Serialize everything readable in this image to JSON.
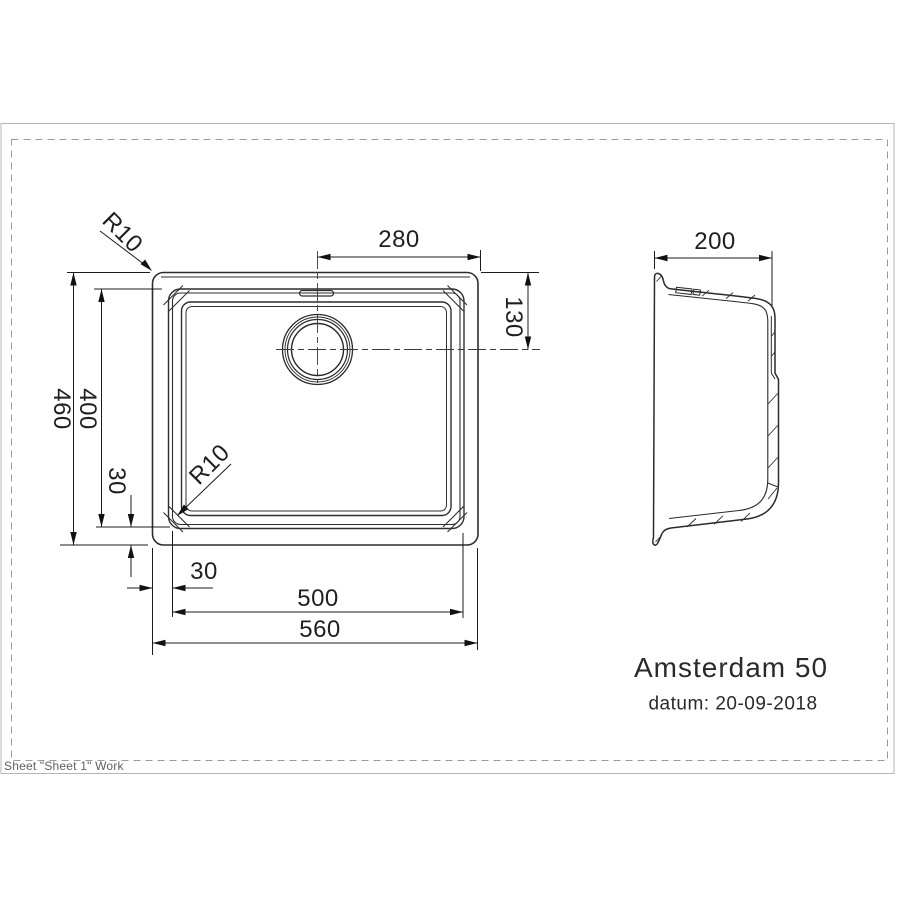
{
  "page": {
    "sheet_label": "Sheet \"Sheet 1\" Work"
  },
  "title_block": {
    "product_name": "Amsterdam 50",
    "date_line": "datum: 20-09-2018"
  },
  "top_view": {
    "dim_overall_width": "560",
    "dim_inner_width": "500",
    "dim_inner_offset_left": "30",
    "dim_overall_height": "460",
    "dim_inner_height": "400",
    "dim_inner_offset_bottom": "30",
    "dim_drain_from_right": "280",
    "dim_drain_from_top": "130",
    "radius_outer_corner": "R10",
    "radius_inner_corner": "R10"
  },
  "side_view": {
    "dim_depth": "200"
  }
}
